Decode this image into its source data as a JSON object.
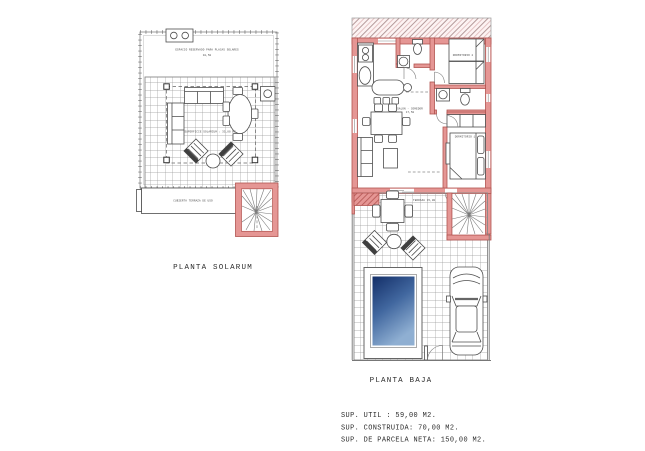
{
  "document": {
    "background": "#ffffff",
    "type": "architectural floor plan drawing"
  },
  "plans": {
    "solarium": {
      "title": "PLANTA SOLARUM",
      "notes": {
        "solar_line1": "ESPACIO RESERVADO PARA PLACAS SOLARES",
        "solar_line2": "10,50",
        "center_note": "SUPERFICIE SOLARIUM : 35,00 M2.",
        "strip_note": "CUBIERTA TERRAZA DE USO"
      }
    },
    "baja": {
      "title": "PLANTA BAJA",
      "notes": {
        "living": "SALON - COMEDOR",
        "living_area": "17,50",
        "bedroom1": "DORMITORIO 1",
        "bedroom2": "DORMITORIO 2",
        "terrace_note": "TERRAZA 15,00"
      }
    }
  },
  "summary": {
    "line1": "SUP. UTIL : 59,00 M2.",
    "line2": "SUP. CONSTRUIDA: 70,00 M2.",
    "line3": "SUP. DE PARCELA NETA: 150,00 M2."
  },
  "colors": {
    "wall_highlight": "#e59694",
    "wall_stroke": "#b25450",
    "pool_dark": "#132e68",
    "pool_light": "#8fafd2",
    "line": "#4d4d4d",
    "grid": "#9a9a9a"
  }
}
